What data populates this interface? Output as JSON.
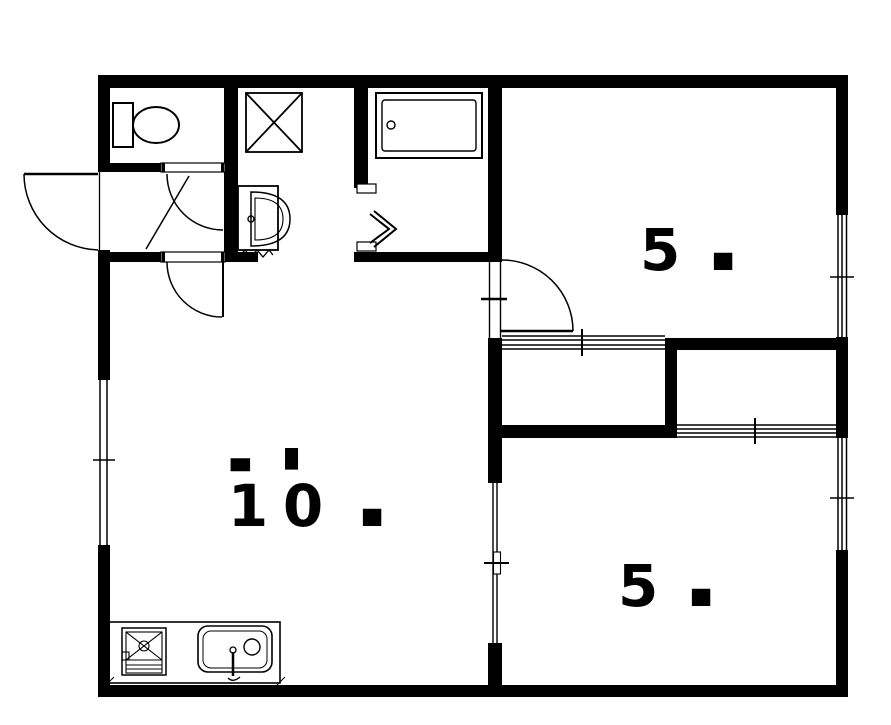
{
  "page": {
    "kind": "floor-plan",
    "background": "#ffffff"
  },
  "colors": {
    "wall": "#000000",
    "line": "#000000",
    "background": "#ffffff"
  },
  "rooms": {
    "bedroom_top": {
      "name": "洋室",
      "size": "5帖",
      "label": "洋室 5帖",
      "size_digits": "5",
      "unit": "帖"
    },
    "bedroom_bottom": {
      "name": "洋室",
      "size": "5帖",
      "label": "洋室 5帖",
      "size_digits": "5",
      "unit": "帖"
    },
    "living": {
      "name": "居間",
      "size": "１０帖",
      "label": "居間 １０帖",
      "digit1": "1",
      "digit2": "0",
      "unit": "帖"
    }
  },
  "fixtures": [
    "toilet",
    "washbasin",
    "shower-pan",
    "bathtub",
    "kitchen-counter",
    "gas-stove",
    "kitchen-sink"
  ],
  "openings": [
    "entrance-door",
    "toilet-door",
    "hall-living-door",
    "bathroom-folding-door",
    "bedroom-top-hinged-door",
    "living-bedroom-sliding-door",
    "closet-top-sliding-door",
    "closet-bottom-sliding-door",
    "window-left",
    "window-right-top",
    "window-right-bottom"
  ]
}
